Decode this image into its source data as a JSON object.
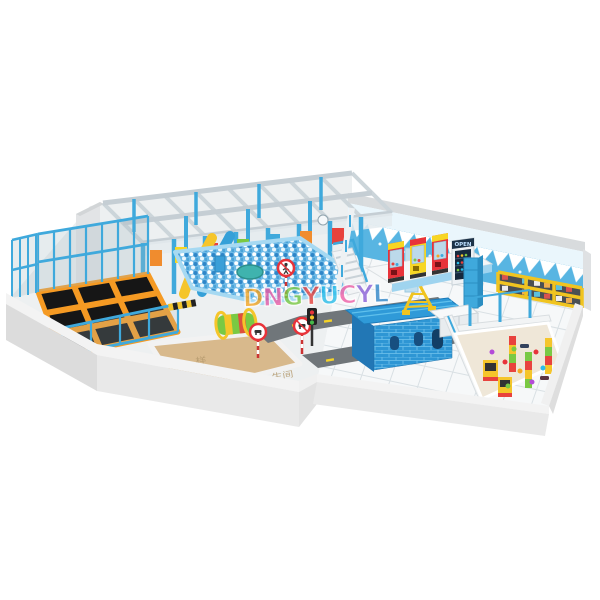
{
  "meta": {
    "title": "Snow and ice themed indoor playground - 3D render",
    "view": "isometric overview",
    "background": "#ffffff"
  },
  "watermark": {
    "text": "DNGYUCYL",
    "letter_colors": [
      "#f5a623",
      "#ef5fa7",
      "#7ac943",
      "#e8423d",
      "#29bdea",
      "#ef5fa7",
      "#8a5fd8",
      "#2f86c8"
    ],
    "opacity": 0.8
  },
  "zones": {
    "play_structure": {
      "label": "multi-level soft play frame",
      "beam": "#ccd5da",
      "post": "#3fa9dc"
    },
    "ball_pit": {
      "label": "ball pit",
      "base": "#6db9e6",
      "ball_white": "#ffffff",
      "ball_dark": "#2f86c8"
    },
    "trampoline": {
      "label": "trampoline park",
      "bed": "#161616",
      "pad": "#f59a23",
      "fence": "#3fa9dc"
    },
    "sand_pit": {
      "label": "sand pit",
      "sand": "#d8b98c"
    },
    "road": {
      "label": "traffic town road",
      "asphalt": "#70767a",
      "lane_mark": "#f5d327"
    },
    "brick_house": {
      "label": "blue brick playhouse",
      "brick": "#2e96d4",
      "roof": "#2f9ad8"
    },
    "toddler": {
      "label": "toddler play area",
      "floor": "#efe7d8"
    },
    "arcade": {
      "label": "claw machine row",
      "machine_colors": [
        "#e8333a",
        "#f7d623",
        "#e8333a"
      ]
    },
    "shoe_shelf": {
      "label": "shoe shelf",
      "frame": "#f0c420"
    },
    "ice_wall": {
      "label": "icicle themed back wall",
      "blue": "#58b5e2",
      "white": "#ffffff"
    }
  },
  "signs": {
    "fridge_sign": "OPEN",
    "floor_label_1": "样",
    "floor_label_2": "生间"
  },
  "traffic": {
    "signs": [
      "no-pedestrians",
      "no-vehicles",
      "no-vehicles"
    ],
    "light_colors": [
      "#e8333a",
      "#f5c52a",
      "#46b94a"
    ]
  },
  "walls": {
    "outer_top": "#f3f3f3",
    "outer_face": "#e9e9e9",
    "left_face": "#dcdcdc",
    "back_cap": "#d8dbdd"
  }
}
